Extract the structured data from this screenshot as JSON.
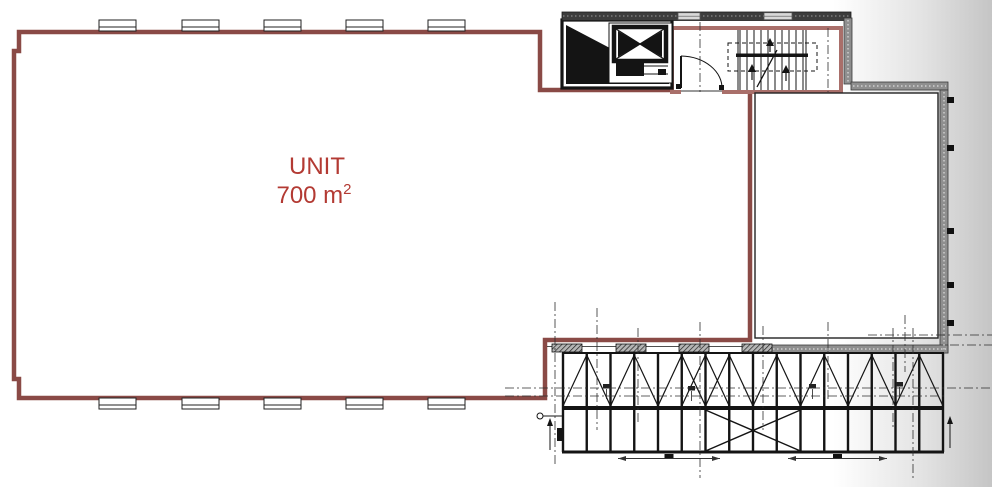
{
  "meta": {
    "drawing_type": "architectural floor plan"
  },
  "unit": {
    "label": "UNIT",
    "area_text": "700 m",
    "area_sup": "2"
  },
  "colors": {
    "unit_wall": "#8a4a46",
    "stair_wall": "#a96f6a",
    "unit_text": "#b33a33",
    "dark_wall": "#3d3d3d",
    "gray_wall": "#8f8f8f",
    "ink": "#141414",
    "grid": "#2e2e2e",
    "bg_edge": "#c5c5c5"
  },
  "geometry": {
    "windows": {
      "xs": [
        99,
        182,
        264,
        346,
        428
      ],
      "w": 37,
      "h": 11,
      "top_y": 20,
      "bottom_y": 398
    },
    "band_windows": [
      {
        "x": 678,
        "w": 22
      },
      {
        "x": 764,
        "w": 28
      }
    ],
    "truss": {
      "x0": 563,
      "x1": 943,
      "n_posts": 17,
      "top": 353,
      "mid": 408,
      "bot": 452,
      "x_bays": [
        5,
        6
      ],
      "lower_x_from": 6,
      "lower_x_to": 10
    },
    "pads": {
      "xs": [
        552,
        616,
        679,
        742
      ],
      "y": 344,
      "w": 30,
      "h": 8
    },
    "wall_ticks_y": [
      97,
      145,
      228,
      282,
      320
    ],
    "stair": {
      "x0": 740,
      "n_treads": 10,
      "step": 7,
      "up_y1": 30,
      "up_y2": 53.5,
      "lo_y1": 57,
      "lo_y2": 90
    },
    "grid_v": [
      {
        "x": 555,
        "y1": 302,
        "y2": 465
      },
      {
        "x": 597,
        "y1": 308,
        "y2": 430
      },
      {
        "x": 638,
        "y1": 328,
        "y2": 425
      },
      {
        "x": 700,
        "y1": 22,
        "y2": 92
      },
      {
        "x": 700,
        "y1": 322,
        "y2": 478
      },
      {
        "x": 763,
        "y1": 326,
        "y2": 430
      },
      {
        "x": 828,
        "y1": 28,
        "y2": 92
      },
      {
        "x": 828,
        "y1": 322,
        "y2": 400
      },
      {
        "x": 893,
        "y1": 328,
        "y2": 430
      },
      {
        "x": 905,
        "y1": 315,
        "y2": 372
      },
      {
        "x": 913,
        "y1": 328,
        "y2": 478
      }
    ],
    "grid_h": [
      {
        "y": 388,
        "x1": 505,
        "x2": 990
      },
      {
        "y": 396,
        "x1": 505,
        "x2": 946
      },
      {
        "y": 335,
        "x1": 868,
        "x2": 992
      },
      {
        "y": 345,
        "x1": 950,
        "x2": 992
      }
    ],
    "dims": [
      {
        "x1": 618,
        "x2": 720,
        "y": 458.5
      },
      {
        "x1": 788,
        "x2": 887,
        "y": 458.5
      }
    ],
    "truss_marks": [
      {
        "x": 603,
        "y": 384
      },
      {
        "x": 688,
        "y": 386
      },
      {
        "x": 809,
        "y": 384
      },
      {
        "x": 896,
        "y": 382
      }
    ]
  }
}
